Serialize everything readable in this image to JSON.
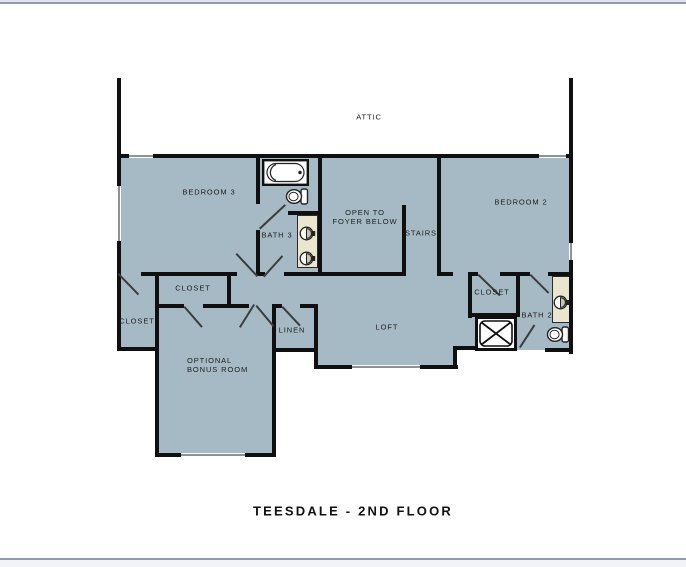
{
  "page": {
    "title": "TEESDALE - 2ND FLOOR"
  },
  "colors": {
    "floor": "#a6bac6",
    "vanity": "#e9e5ce",
    "wall": "#101010",
    "window_line": "#8d9298",
    "door_line": "#3c3c3c",
    "text": "#1c1c1c",
    "page_edge": "#9298ae"
  },
  "rooms": {
    "attic": {
      "label": "ATTIC"
    },
    "bedroom3": {
      "label": "BEDROOM 3"
    },
    "bath3": {
      "label": "BATH 3"
    },
    "open_to_foyer": {
      "label": "OPEN TO\nFOYER BELOW"
    },
    "stairs": {
      "label": "STAIRS"
    },
    "bedroom2": {
      "label": "BEDROOM 2"
    },
    "closet_bedroom3": {
      "label": "CLOSET"
    },
    "closet_bonus": {
      "label": "CLOSET"
    },
    "linen": {
      "label": "LINEN"
    },
    "bonus_room": {
      "label": "OPTIONAL\nBONUS ROOM"
    },
    "loft": {
      "label": "LOFT"
    },
    "closet_bedroom2": {
      "label": "CLOSET"
    },
    "bath2": {
      "label": "BATH 2"
    }
  },
  "fixtures": {
    "bathtub": "bathtub-icon",
    "toilet_bath3": "toilet-icon",
    "toilet_bath2": "toilet-icon",
    "sink_bath3_a": "sink-icon",
    "sink_bath3_b": "sink-icon",
    "sink_bath2": "sink-icon",
    "attic_access": "x-box-marker"
  }
}
